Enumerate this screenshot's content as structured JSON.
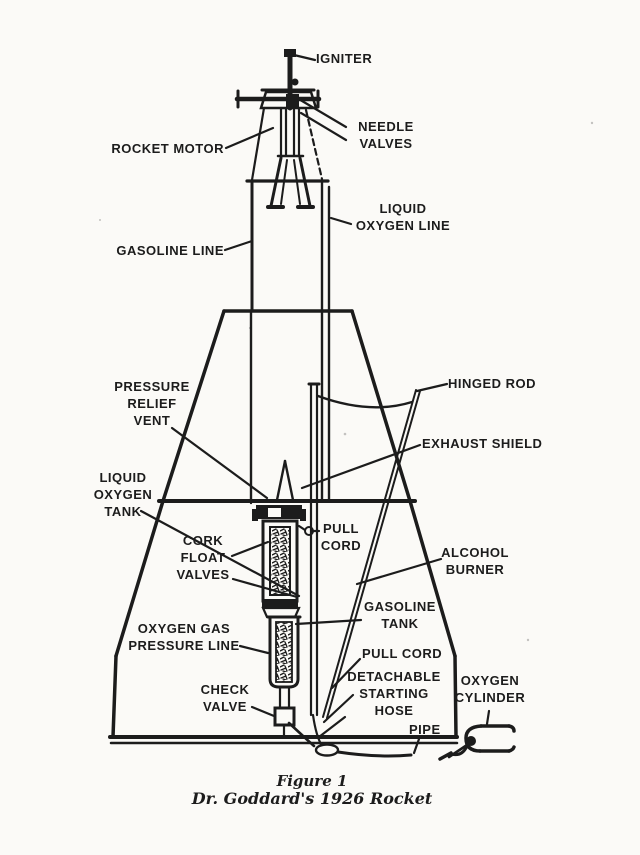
{
  "page": {
    "paper_color": "#fbfaf7",
    "ink_color": "#1c1c1c"
  },
  "labels": {
    "igniter": "IGNITER",
    "rocket_motor": "ROCKET MOTOR",
    "needle_valves": "NEEDLE\nVALVES",
    "liquid_oxygen_line": "LIQUID\nOXYGEN LINE",
    "gasoline_line": "GASOLINE LINE",
    "pressure_relief_vent": "PRESSURE\nRELIEF\nVENT",
    "hinged_rod": "HINGED ROD",
    "exhaust_shield": "EXHAUST SHIELD",
    "liquid_oxygen_tank": "LIQUID\nOXYGEN\nTANK",
    "cork_float_valves": "CORK\nFLOAT\nVALVES",
    "pull_cord_upper": "PULL\nCORD",
    "alcohol_burner": "ALCOHOL\nBURNER",
    "gasoline_tank": "GASOLINE\nTANK",
    "oxygen_gas_pressure_line": "OXYGEN GAS\nPRESSURE LINE",
    "pull_cord_lower": "PULL CORD",
    "detachable_starting_hose": "DETACHABLE\nSTARTING\nHOSE",
    "check_valve": "CHECK\nVALVE",
    "pipe": "PIPE",
    "oxygen_cylinder": "OXYGEN\nCYLINDER"
  },
  "caption": {
    "line1": "Figure 1",
    "line2": "Dr. Goddard's 1926 Rocket"
  }
}
